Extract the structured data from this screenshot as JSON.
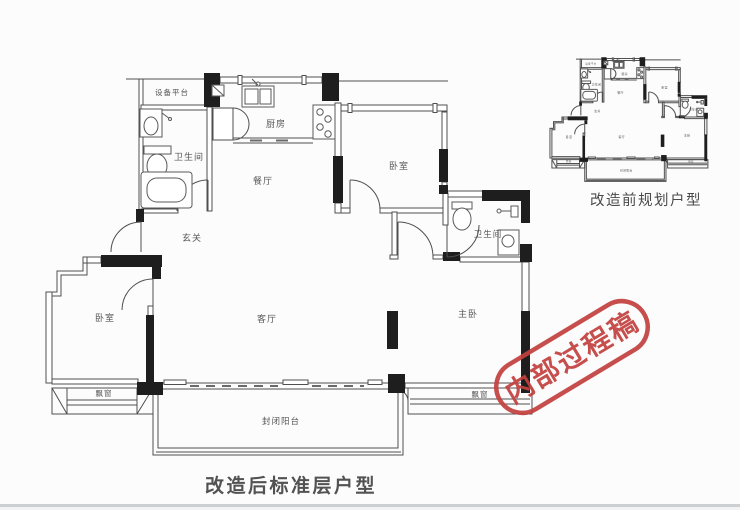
{
  "colors": {
    "stamp_red": "#c2403e",
    "wall_black": "#1e1e1e",
    "line_gray": "#4f4f4f",
    "label_gray": "#575757"
  },
  "main_plan": {
    "caption": "改造后标准层户型",
    "rooms": {
      "equipment_platform": "设备平台",
      "bathroom_left": "卫生间",
      "kitchen": "厨房",
      "dining": "餐厅",
      "bedroom_top": "卧室",
      "bathroom_right": "卫生间",
      "foyer": "玄关",
      "bedroom_left": "卧室",
      "living": "客厅",
      "master_bedroom": "主卧",
      "bay_window_left": "飘窗",
      "bay_window_right": "飘窗",
      "balcony": "封闭阳台"
    }
  },
  "mini_plan": {
    "caption": "改造前规划户型"
  },
  "stamp": {
    "text": "内部过程稿"
  }
}
